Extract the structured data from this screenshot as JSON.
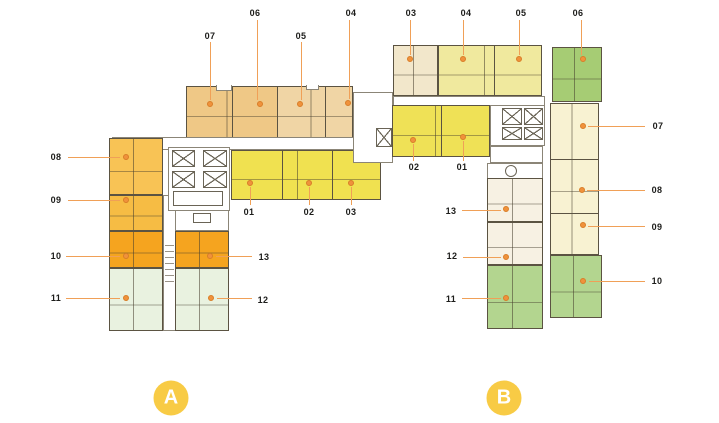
{
  "building_a": {
    "badge": "A",
    "units": [
      {
        "no": "01",
        "color": "#F0E150"
      },
      {
        "no": "02",
        "color": "#F0E150"
      },
      {
        "no": "03",
        "color": "#F0E150"
      },
      {
        "no": "04",
        "color": "#F0D5A5"
      },
      {
        "no": "05",
        "color": "#F0D5A5"
      },
      {
        "no": "06",
        "color": "#EFC886"
      },
      {
        "no": "07",
        "color": "#EFC886"
      },
      {
        "no": "08",
        "color": "#F8C355"
      },
      {
        "no": "09",
        "color": "#F6BC44"
      },
      {
        "no": "10",
        "color": "#F5A41F"
      },
      {
        "no": "11",
        "color": "#E9F2E0"
      },
      {
        "no": "12",
        "color": "#E9F2E0"
      },
      {
        "no": "13",
        "color": "#F5A41F"
      }
    ]
  },
  "building_b": {
    "badge": "B",
    "units": [
      {
        "no": "01",
        "color": "#EFE156"
      },
      {
        "no": "02",
        "color": "#EFE156"
      },
      {
        "no": "03",
        "color": "#F2E7CB"
      },
      {
        "no": "04",
        "color": "#F0E99E"
      },
      {
        "no": "05",
        "color": "#F0E99E"
      },
      {
        "no": "06",
        "color": "#A6CC74"
      },
      {
        "no": "07",
        "color": "#F8F2D2"
      },
      {
        "no": "08",
        "color": "#F8F2D2"
      },
      {
        "no": "09",
        "color": "#F8F2D2"
      },
      {
        "no": "10",
        "color": "#B3D58F"
      },
      {
        "no": "11",
        "color": "#B3D58F"
      },
      {
        "no": "12",
        "color": "#F7F1E3"
      },
      {
        "no": "13",
        "color": "#F7F1E3"
      }
    ]
  },
  "style": {
    "leader_line_color": "#F0A057",
    "callout_dot_color": "#F0923C",
    "badge_color": "#F8CB45",
    "wall_color": "#5B5342"
  }
}
